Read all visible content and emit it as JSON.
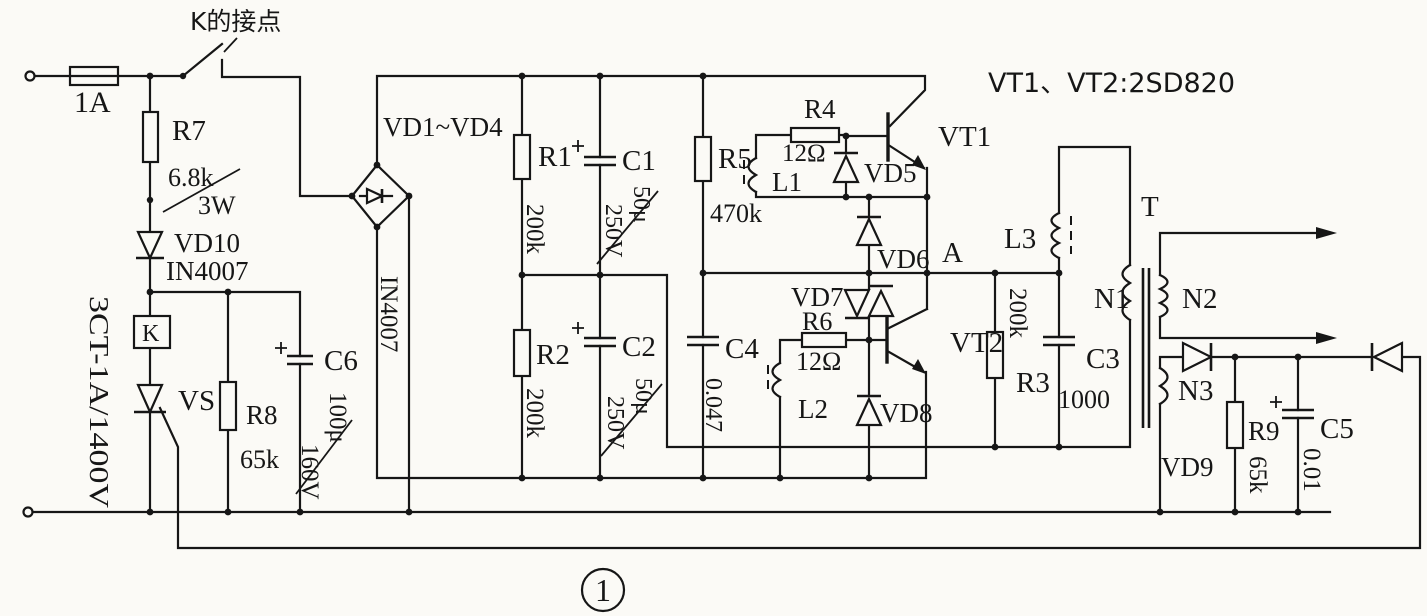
{
  "schematic": {
    "figure_number": "1",
    "colors": {
      "ink": "#161616",
      "paper": "#fbfaf6"
    },
    "labels": {
      "fuse": "1A",
      "switch_contact": "K的接点",
      "r7": "R7",
      "r7_value": "6.8k",
      "r7_power": "3W",
      "vd10": "VD10",
      "vd10_part": "IN4007",
      "scr_spec": "3CT-1A/1400V",
      "relay": "K",
      "vs": "VS",
      "r8": "R8",
      "r8_value": "65k",
      "c6": "C6",
      "c6_value": "100μ",
      "c6_voltage": "160V",
      "bridge": "VD1~VD4",
      "bridge_part": "IN4007",
      "r1": "R1",
      "r1_value": "200k",
      "c1": "C1",
      "c1_value": "50μ",
      "c1_voltage": "250V",
      "r2": "R2",
      "r2_value": "200k",
      "c2": "C2",
      "c2_value": "50μ",
      "c2_voltage": "250V",
      "c4": "C4",
      "c4_value": "0.047",
      "r5": "R5",
      "r5_value": "470k",
      "r4": "R4",
      "r4_value": "12Ω",
      "l1": "L1",
      "vd5": "VD5",
      "vd6": "VD6",
      "vd7": "VD7",
      "vd8": "VD8",
      "r6": "R6",
      "r6_value": "12Ω",
      "l2": "L2",
      "vt1": "VT1",
      "vt2": "VT2",
      "transistor_note": "VT1、VT2:2SD820",
      "node_a": "A",
      "l3": "L3",
      "r3": "R3",
      "r3_value": "200k",
      "c3": "C3",
      "c3_value": "1000",
      "transformer": "T",
      "n1": "N1",
      "n2": "N2",
      "n3": "N3",
      "vd9": "VD9",
      "r9": "R9",
      "r9_value": "65k",
      "c5": "C5",
      "c5_value": "0.01"
    }
  }
}
